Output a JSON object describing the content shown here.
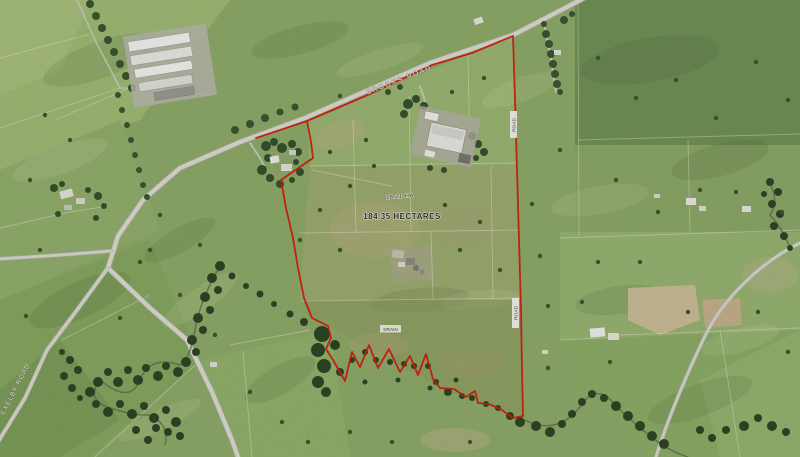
{
  "map": {
    "type": "aerial-imagery-with-parcel-boundary",
    "labels": {
      "road_top": "BROOKS ROAD",
      "road_bottom_left": "EXELBY ROAD",
      "boundary_upper": "ROAD",
      "boundary_lower": "ROAD",
      "parcel_line1": "18.21 HA",
      "parcel_line2": "184.35 HECTARES",
      "stream": "DRAIN"
    },
    "colors": {
      "field_green": "#8ca768",
      "road_grey": "#d8d7ce",
      "bush_dark": "#2e4424",
      "bare_tan": "#c8b995",
      "boundary_red": "#cc1f0e"
    }
  }
}
